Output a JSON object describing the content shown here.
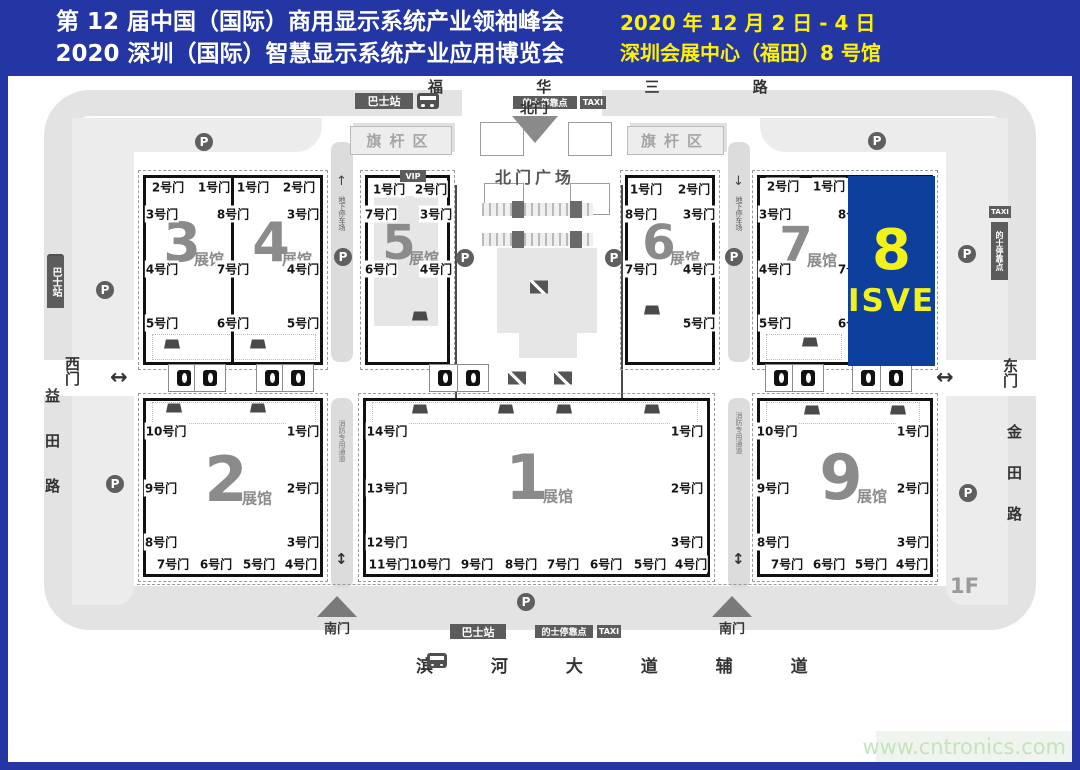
{
  "header": {
    "title_line1": "第 12 届中国（国际）商用显示系统产业领袖峰会",
    "title_line2": "2020 深圳（国际）智慧显示系统产业应用博览会",
    "date_line": "2020 年 12 月 2 日 - 4 日",
    "venue_line": "深圳会展中心（福田）8 号馆"
  },
  "watermark": "www.cntronics.com",
  "colors": {
    "header_blue": "#2336a4",
    "hall8_blue": "#0c409c",
    "accent_yellow": "#fff200"
  },
  "map": {
    "roads": {
      "north": "福 华 三 路",
      "south": "滨 河 大 道 辅 道",
      "west": "益田路",
      "east": "金田路"
    },
    "gates": {
      "north": "北门",
      "north_plaza": "北门广场",
      "south": "南门",
      "west": "西门",
      "east": "东门"
    },
    "badges": {
      "bus": "巴士站",
      "taxi_stop": "的士停靠点",
      "taxi": "TAXI",
      "flag_area": "旗杆区",
      "underground": "地下停车场",
      "fire_lane": "消防专用通道",
      "vip": "VIP",
      "floor": "1F"
    },
    "hall_suffix": "展馆",
    "hall8": {
      "number": "8",
      "label": "ISVE"
    },
    "halls": [
      {
        "number": "3",
        "nx": 182,
        "ny": 243,
        "ns": 54,
        "sx": 209,
        "sy": 259,
        "doors": [
          {
            "t": "2号门",
            "x": 168,
            "y": 187
          },
          {
            "t": "1号门",
            "x": 214,
            "y": 187
          },
          {
            "t": "3号门",
            "x": 162,
            "y": 214
          },
          {
            "t": "4号门",
            "x": 162,
            "y": 269
          },
          {
            "t": "5号门",
            "x": 162,
            "y": 323
          },
          {
            "t": "8号门",
            "x": 233,
            "y": 214
          },
          {
            "t": "7号门",
            "x": 233,
            "y": 269
          },
          {
            "t": "6号门",
            "x": 233,
            "y": 323
          }
        ]
      },
      {
        "number": "4",
        "nx": 271,
        "ny": 243,
        "ns": 54,
        "sx": 297,
        "sy": 259,
        "doors": [
          {
            "t": "1号门",
            "x": 253,
            "y": 187
          },
          {
            "t": "2号门",
            "x": 299,
            "y": 187
          },
          {
            "t": "3号门",
            "x": 303,
            "y": 214
          },
          {
            "t": "4号门",
            "x": 303,
            "y": 269
          },
          {
            "t": "5号门",
            "x": 303,
            "y": 323
          }
        ]
      },
      {
        "number": "5",
        "nx": 399,
        "ny": 243,
        "ns": 48,
        "sx": 424,
        "sy": 258,
        "doors": [
          {
            "t": "1号门",
            "x": 389,
            "y": 189
          },
          {
            "t": "2号门",
            "x": 431,
            "y": 189
          },
          {
            "t": "7号门",
            "x": 381,
            "y": 214
          },
          {
            "t": "6号门",
            "x": 381,
            "y": 269
          },
          {
            "t": "3号门",
            "x": 436,
            "y": 214
          },
          {
            "t": "4号门",
            "x": 436,
            "y": 269
          }
        ]
      },
      {
        "number": "6",
        "nx": 659,
        "ny": 243,
        "ns": 48,
        "sx": 685,
        "sy": 258,
        "doors": [
          {
            "t": "1号门",
            "x": 646,
            "y": 189
          },
          {
            "t": "2号门",
            "x": 694,
            "y": 189
          },
          {
            "t": "8号门",
            "x": 641,
            "y": 214
          },
          {
            "t": "7号门",
            "x": 641,
            "y": 269
          },
          {
            "t": "3号门",
            "x": 699,
            "y": 214
          },
          {
            "t": "4号门",
            "x": 699,
            "y": 269
          },
          {
            "t": "5号门",
            "x": 699,
            "y": 323
          }
        ]
      },
      {
        "number": "7",
        "nx": 796,
        "ny": 245,
        "ns": 48,
        "sx": 822,
        "sy": 260,
        "doors": [
          {
            "t": "2号门",
            "x": 783,
            "y": 186
          },
          {
            "t": "1号门",
            "x": 829,
            "y": 186
          },
          {
            "t": "3号门",
            "x": 775,
            "y": 214
          },
          {
            "t": "4号门",
            "x": 775,
            "y": 269
          },
          {
            "t": "5号门",
            "x": 775,
            "y": 323
          },
          {
            "t": "8号门",
            "x": 854,
            "y": 214
          },
          {
            "t": "7号门",
            "x": 854,
            "y": 269
          },
          {
            "t": "6号门",
            "x": 854,
            "y": 323
          }
        ]
      },
      {
        "number": "2",
        "nx": 226,
        "ny": 480,
        "ns": 62,
        "sx": 257,
        "sy": 498,
        "doors": [
          {
            "t": "10号门",
            "x": 166,
            "y": 431
          },
          {
            "t": "9号门",
            "x": 161,
            "y": 488
          },
          {
            "t": "8号门",
            "x": 161,
            "y": 542
          },
          {
            "t": "1号门",
            "x": 303,
            "y": 431
          },
          {
            "t": "2号门",
            "x": 303,
            "y": 488
          },
          {
            "t": "3号门",
            "x": 303,
            "y": 542
          },
          {
            "t": "7号门",
            "x": 173,
            "y": 564
          },
          {
            "t": "6号门",
            "x": 216,
            "y": 564
          },
          {
            "t": "5号门",
            "x": 259,
            "y": 564
          },
          {
            "t": "4号门",
            "x": 301,
            "y": 564
          }
        ]
      },
      {
        "number": "1",
        "nx": 527,
        "ny": 478,
        "ns": 62,
        "sx": 558,
        "sy": 496,
        "doors": [
          {
            "t": "14号门",
            "x": 387,
            "y": 431
          },
          {
            "t": "13号门",
            "x": 387,
            "y": 488
          },
          {
            "t": "12号门",
            "x": 387,
            "y": 542
          },
          {
            "t": "1号门",
            "x": 687,
            "y": 431
          },
          {
            "t": "2号门",
            "x": 687,
            "y": 488
          },
          {
            "t": "3号门",
            "x": 687,
            "y": 542
          },
          {
            "t": "11号门",
            "x": 389,
            "y": 564
          },
          {
            "t": "10号门",
            "x": 430,
            "y": 564
          },
          {
            "t": "9号门",
            "x": 477,
            "y": 564
          },
          {
            "t": "8号门",
            "x": 521,
            "y": 564
          },
          {
            "t": "7号门",
            "x": 563,
            "y": 564
          },
          {
            "t": "6号门",
            "x": 606,
            "y": 564
          },
          {
            "t": "5号门",
            "x": 650,
            "y": 564
          },
          {
            "t": "4号门",
            "x": 691,
            "y": 564
          }
        ]
      },
      {
        "number": "9",
        "nx": 841,
        "ny": 478,
        "ns": 62,
        "sx": 872,
        "sy": 496,
        "doors": [
          {
            "t": "10号门",
            "x": 777,
            "y": 431
          },
          {
            "t": "9号门",
            "x": 773,
            "y": 488
          },
          {
            "t": "8号门",
            "x": 773,
            "y": 542
          },
          {
            "t": "1号门",
            "x": 913,
            "y": 431
          },
          {
            "t": "2号门",
            "x": 913,
            "y": 488
          },
          {
            "t": "3号门",
            "x": 913,
            "y": 542
          },
          {
            "t": "7号门",
            "x": 787,
            "y": 564
          },
          {
            "t": "6号门",
            "x": 829,
            "y": 564
          },
          {
            "t": "5号门",
            "x": 871,
            "y": 564
          },
          {
            "t": "4号门",
            "x": 912,
            "y": 564
          }
        ]
      }
    ],
    "p_icons": [
      [
        204,
        142
      ],
      [
        877,
        141
      ],
      [
        105,
        290
      ],
      [
        343,
        257
      ],
      [
        465,
        258
      ],
      [
        614,
        258
      ],
      [
        734,
        257
      ],
      [
        967,
        254
      ],
      [
        115,
        484
      ],
      [
        968,
        493
      ],
      [
        526,
        602
      ]
    ],
    "elevator_icons": [
      184,
      210,
      272,
      298,
      445,
      473,
      781,
      808,
      868,
      896
    ],
    "escalator_icons": [
      [
        539,
        287
      ],
      [
        517,
        378
      ],
      [
        563,
        378
      ]
    ],
    "ac_units": [
      [
        172,
        344
      ],
      [
        258,
        344
      ],
      [
        420,
        316
      ],
      [
        652,
        310
      ],
      [
        810,
        342
      ],
      [
        174,
        408
      ],
      [
        258,
        408
      ],
      [
        420,
        409
      ],
      [
        506,
        409
      ],
      [
        564,
        409
      ],
      [
        652,
        409
      ],
      [
        812,
        410
      ],
      [
        898,
        410
      ]
    ]
  }
}
